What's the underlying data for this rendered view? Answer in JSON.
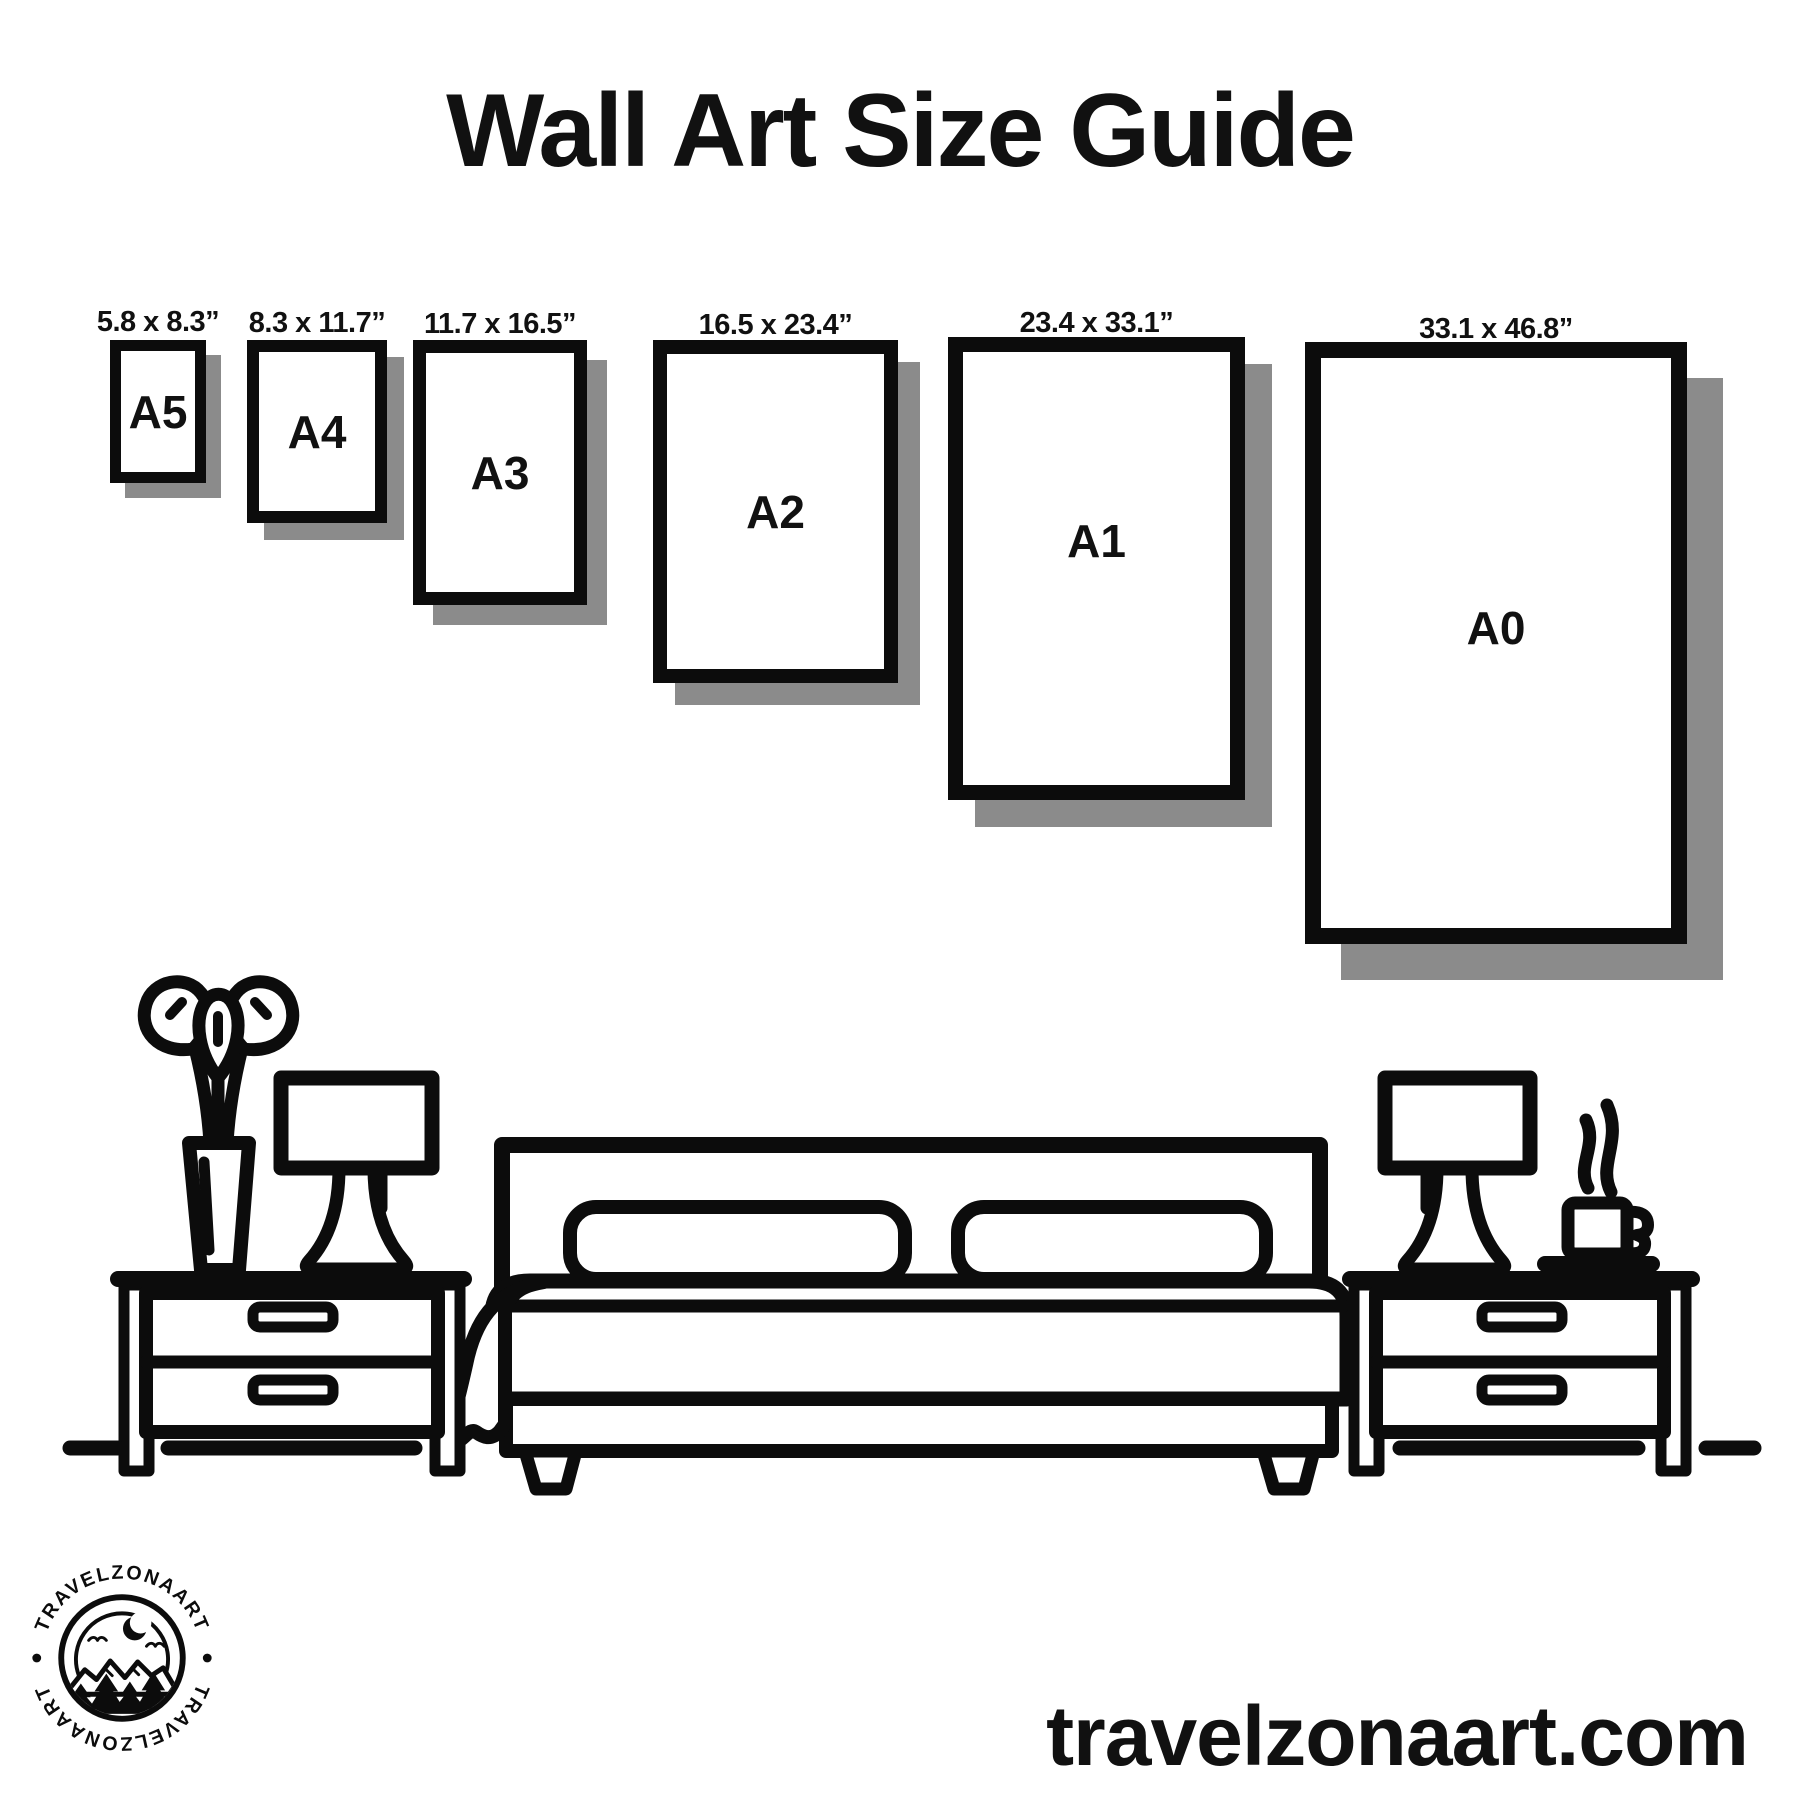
{
  "title": "Wall Art Size Guide",
  "frames": [
    {
      "id": "a5",
      "label": "A5",
      "dims": "5.8 x 8.3”"
    },
    {
      "id": "a4",
      "label": "A4",
      "dims": "8.3 x 11.7”"
    },
    {
      "id": "a3",
      "label": "A3",
      "dims": "11.7 x 16.5”"
    },
    {
      "id": "a2",
      "label": "A2",
      "dims": "16.5 x 23.4”"
    },
    {
      "id": "a1",
      "label": "A1",
      "dims": "23.4 x 33.1”"
    },
    {
      "id": "a0",
      "label": "A0",
      "dims": "33.1 x 46.8”"
    }
  ],
  "logo": {
    "brand_top": "TRAVELZONAART",
    "brand_bottom": "TRAVELZONAART"
  },
  "website": "travelzonaart.com",
  "colors": {
    "ink": "#0c0c0c",
    "shadow": "#8b8b8b",
    "background": "#ffffff"
  }
}
